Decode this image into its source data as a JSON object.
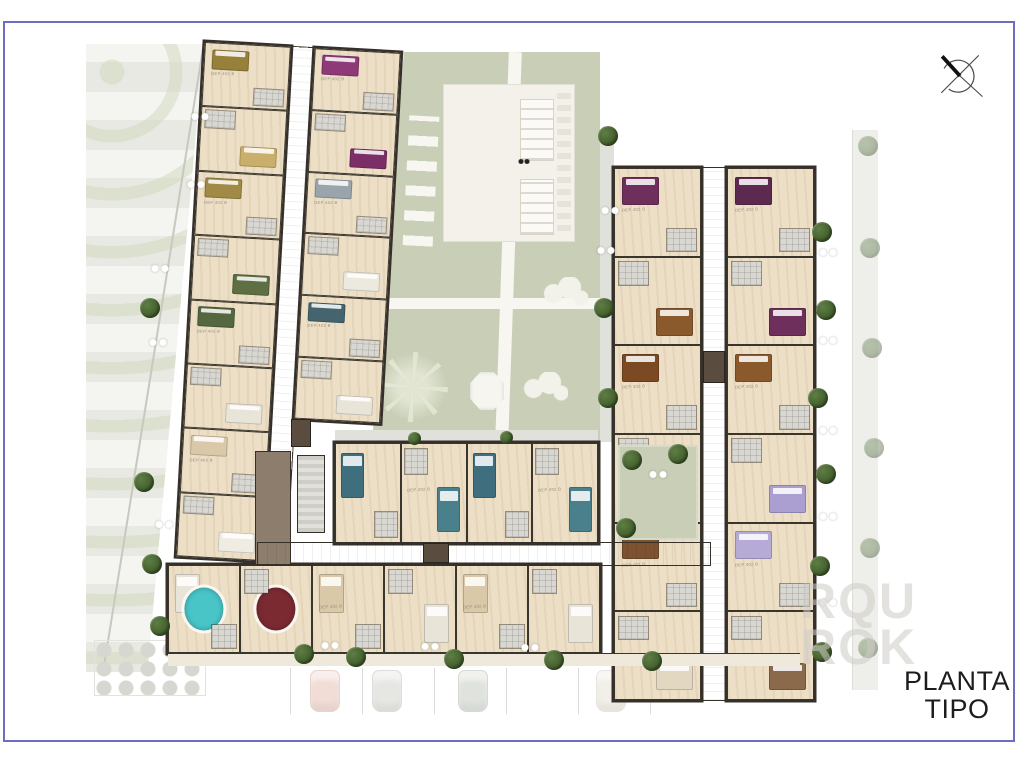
{
  "title": {
    "line1": "PLANTA",
    "line2": "TIPO"
  },
  "watermark": {
    "line1": "RQU",
    "line2": "ROK"
  },
  "compass": {
    "name": "north-compass"
  },
  "plan": {
    "palette": {
      "courtyard": "#c9cfb6",
      "walkway": "#e1e1dc",
      "path": "#f7f6f1",
      "floor": "#ecdfc6",
      "wall": "#35302a",
      "corridor": "#8e7f6f",
      "tile": "#d9d7d1",
      "terrace": "#f3f1ea",
      "balcony": "#efe9dc",
      "core": "#5a4c3e",
      "tree": "#46632f",
      "frame": "#6f6cc4"
    },
    "unit_label": "DEP 402 B",
    "wings": {
      "left_west": {
        "units": [
          {
            "bed": "#97803a",
            "label": true
          },
          {
            "bed": "#c9af6b"
          },
          {
            "bed": "#a08a45",
            "label": true
          },
          {
            "bed": "#5e6f44"
          },
          {
            "bed": "#55673f",
            "label": true
          },
          {
            "bed": "#e9e4d8"
          },
          {
            "bed": "#d9c9a8",
            "label": true
          },
          {
            "bed": "#efece4"
          }
        ]
      },
      "left_east": {
        "units": [
          {
            "bed": "#8e3a78",
            "label": true
          },
          {
            "bed": "#7c2f66"
          },
          {
            "bed": "#9aa4ac",
            "label": true
          },
          {
            "bed": "#eceadf"
          },
          {
            "bed": "#44646e",
            "label": true
          },
          {
            "bed": "#e9e4d8"
          }
        ]
      },
      "right_west": {
        "units": [
          {
            "bed": "#6e2f5c",
            "label": true
          },
          {
            "bed": "#8a5a2c"
          },
          {
            "bed": "#7c4a22",
            "label": true
          },
          {
            "bed": "#d8d4c8"
          },
          {
            "bed": "#7c5230",
            "label": true
          },
          {
            "bed": "#e2d8c2"
          }
        ]
      },
      "right_east": {
        "units": [
          {
            "bed": "#5c2a50",
            "label": true
          },
          {
            "bed": "#6e2f5c"
          },
          {
            "bed": "#8a5a2c",
            "label": true
          },
          {
            "bed": "#ab9fd1"
          },
          {
            "bed": "#b6aad6",
            "label": true
          },
          {
            "bed": "#8a6a4a"
          }
        ]
      },
      "bottom_inner": {
        "units": [
          {
            "bed": "#3f6f7f"
          },
          {
            "bed": "#4a808c",
            "label": true
          },
          {
            "bed": "#3f6f7f"
          },
          {
            "bed": "#4a808c",
            "label": true
          }
        ]
      },
      "bottom_outer": {
        "units": [
          {
            "rug": "#49c5c8",
            "bed": "#e9e4d8"
          },
          {
            "rug": "#7c2a32"
          },
          {
            "bed": "#d9c9a8",
            "label": true
          },
          {
            "bed": "#e9e4d8"
          },
          {
            "bed": "#d9c9a8",
            "label": true
          },
          {
            "bed": "#e9e4d8"
          }
        ]
      }
    },
    "parking": {
      "cars": [
        {
          "color": "#eac6bb"
        },
        {
          "color": "#d7d7d2"
        },
        {
          "color": "#ccd2c8"
        },
        {
          "color": "#e9e5d8"
        }
      ]
    }
  }
}
